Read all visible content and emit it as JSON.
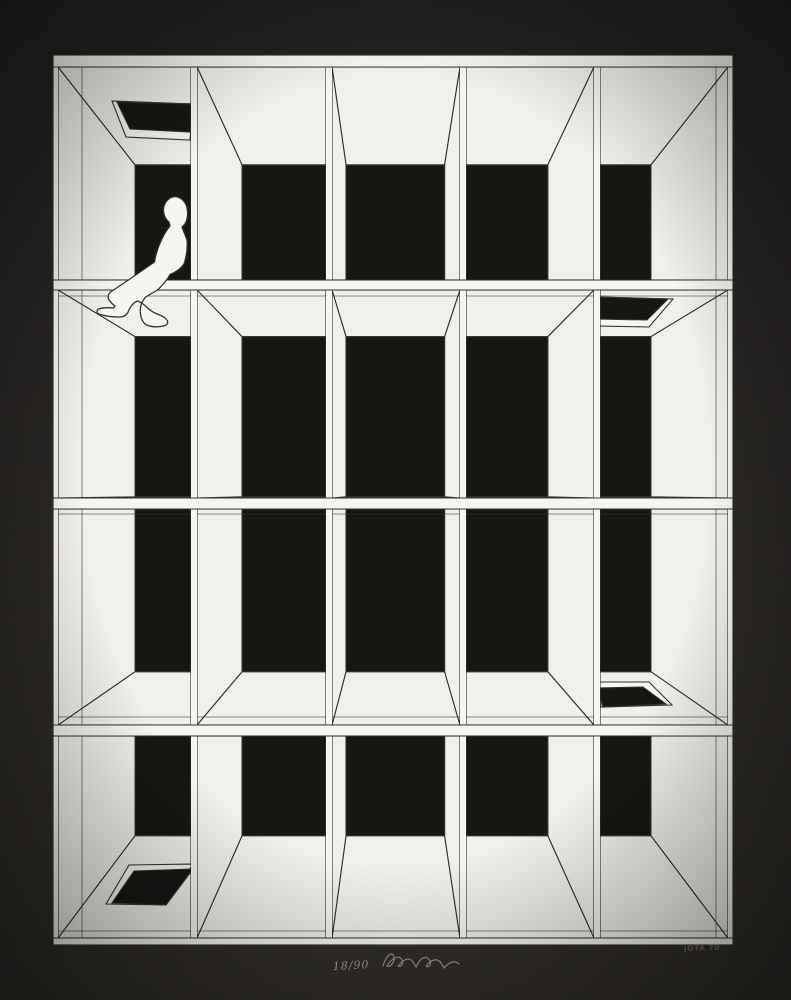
{
  "artwork": {
    "description": "Black-and-white geometric print: a small human figure seated on a shelf of a large one-point-perspective lattice of 20 open cells (5 columns x 4 rows) against a black field, on a dark mat.",
    "palette": {
      "matTop": "#232120",
      "matBottom": "#312e2a",
      "void": "#171613",
      "face": "#f1efe9",
      "faceB": "#f7f5f0",
      "line": "#34322c",
      "pencil": "#8b8881",
      "plate": "#45433c"
    },
    "canvas": {
      "width": 791,
      "height": 1000
    },
    "geometry": {
      "vp": [
        393,
        493
      ],
      "depth": 0.23,
      "outer": [
        53,
        55,
        733,
        945
      ],
      "col_bands": [
        [
          53,
          58
        ],
        [
          191,
          197
        ],
        [
          326,
          332
        ],
        [
          460,
          466
        ],
        [
          594,
          600
        ],
        [
          728,
          733
        ]
      ],
      "row_bands": [
        [
          55,
          67
        ],
        [
          280,
          290
        ],
        [
          498,
          509
        ],
        [
          725,
          736
        ],
        [
          938,
          945
        ]
      ],
      "shelf_lines": [
        67,
        280,
        290,
        498,
        509,
        725,
        736,
        938
      ],
      "seams": {
        "vertical": [
          {
            "x": 82,
            "col": 0
          },
          {
            "x": 716,
            "col": 4
          }
        ],
        "horizontal": [
          {
            "y": 296,
            "row": 1
          },
          {
            "y": 514,
            "row": 2
          },
          {
            "y": 717,
            "row": 2
          },
          {
            "y": 931,
            "row": 3
          }
        ]
      },
      "holes": [
        {
          "row": 0,
          "col": 0,
          "outer": [
            [
              112,
              101
            ],
            [
              193,
              104
            ],
            [
              190,
              140
            ],
            [
              126,
              137
            ]
          ],
          "black": [
            [
              117,
              102
            ],
            [
              193,
              104
            ],
            [
              190,
              132
            ],
            [
              130,
              129
            ]
          ]
        },
        {
          "row": 1,
          "col": 4,
          "outer": [
            [
              597,
              297
            ],
            [
              673,
              299
            ],
            [
              649,
              327
            ],
            [
              597,
              326
            ]
          ],
          "black": [
            [
              597,
              297
            ],
            [
              668,
              299
            ],
            [
              647,
              320
            ],
            [
              597,
              319
            ]
          ]
        },
        {
          "row": 2,
          "col": 4,
          "outer": [
            [
              597,
              682
            ],
            [
              649,
              682
            ],
            [
              672,
              705
            ],
            [
              601,
              707
            ]
          ],
          "black": [
            [
              597,
              688
            ],
            [
              643,
              687
            ],
            [
              666,
              704
            ],
            [
              603,
              707
            ]
          ]
        },
        {
          "row": 3,
          "col": 0,
          "outer": [
            [
              129,
              865
            ],
            [
              193,
              864
            ],
            [
              166,
              905
            ],
            [
              106,
              904
            ]
          ],
          "black": [
            [
              134,
              871
            ],
            [
              193,
              869
            ],
            [
              166,
              905
            ],
            [
              112,
              903
            ]
          ]
        }
      ]
    },
    "figure": {
      "name": "seated person in profile facing left, legs dangling over shelf edge",
      "path": "M170,198 Q163,203 163.5,211 Q164,218 169,222 L170,226 Q165,232 160.5,242 Q156,252 154.5,262 Q143,270 127,281 L112,291 Q107,294 108.5,299 Q111,303 115,306 L113.5,308 Q104,307 98.5,309 Q95.5,311 98.5,314 Q108,317 119,317 Q126.5,317 128.5,311 Q132,303 137.5,301 Q143,303 147.5,308 Q153.5,313 159.5,315 Q165.5,317 167.5,321 Q168.5,325 163.5,326 Q153.5,328 146.5,325 Q141.5,322 140.5,314 Q139,305 145.5,297 L157.5,290 Q166,282 170,274.5 Q179,271 184,264 Q188,252 187,240 L182,227 Q186.5,224 187.5,216 Q188.5,202 179,197.5 Q174.5,195.5 170,198 Z"
    },
    "inscriptions": {
      "edition": "18/90",
      "plate": "JOTA 70",
      "signature_path": "M383,966 C386,956 392,950 394,957 C395,962 390,968 387,966 C392,958 399,954 402,960 C404,964 400,968 398,966 C403,960 409,956 413,962 L416,967 C420,958 426,954 430,961 C432,965 428,968 426,966 C431,960 437,957 441,963 L444,968 C449,962 455,960 459,964"
    }
  }
}
